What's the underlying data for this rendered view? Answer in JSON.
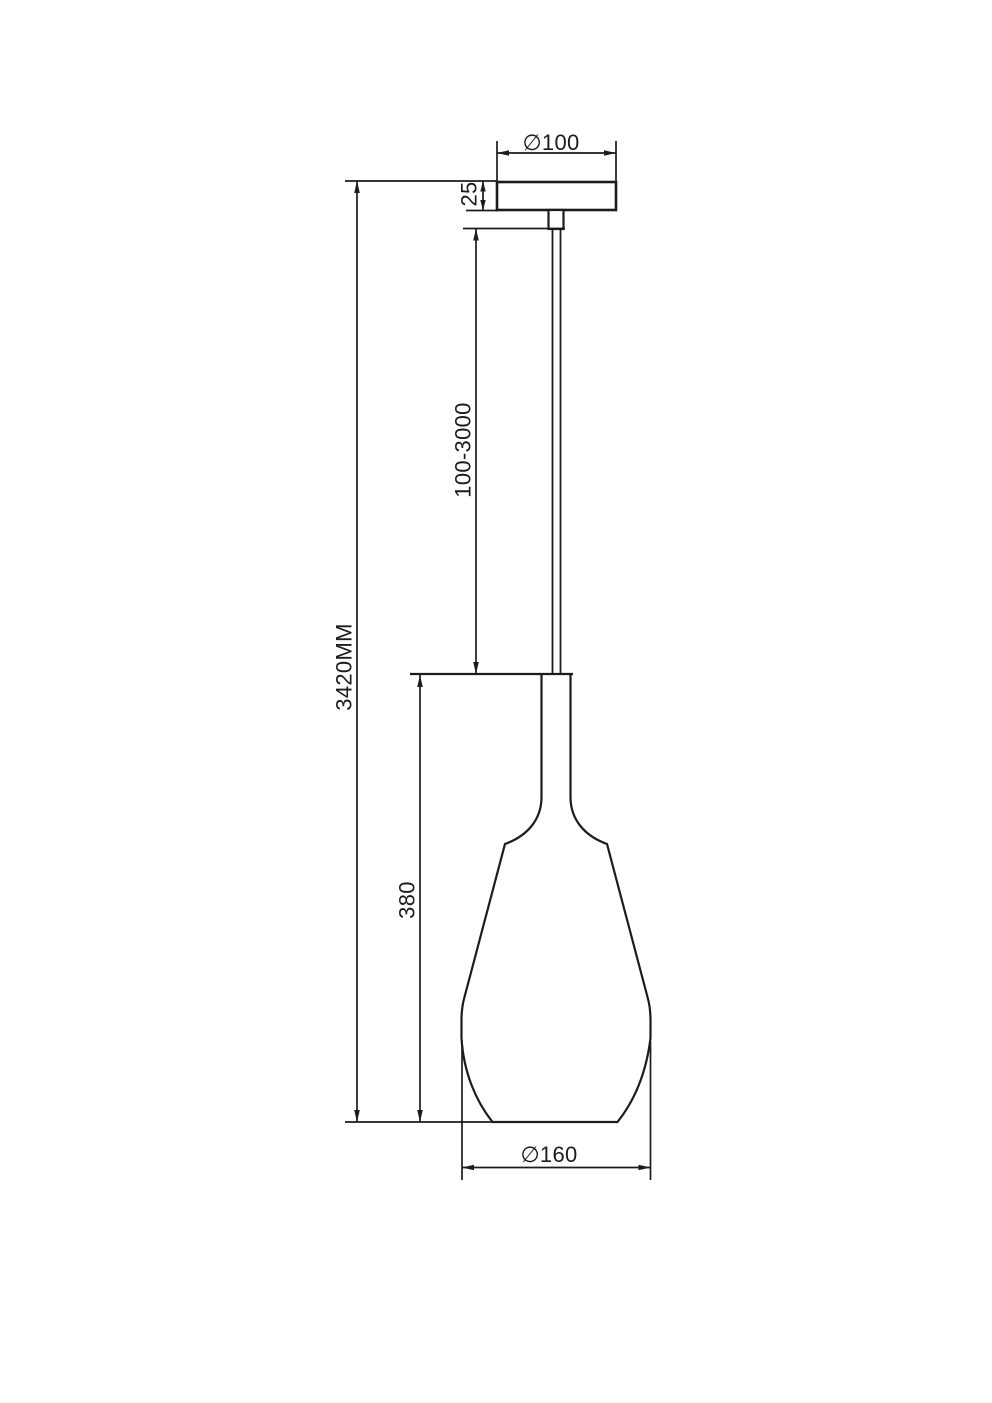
{
  "drawing": {
    "subject": "Pendant lamp technical dimension drawing",
    "background": "#ffffff",
    "line_color": "#1c1c1c",
    "dimensions": {
      "canopy_diameter": "∅100",
      "canopy_height": "25",
      "suspension_length": "100-3000",
      "overall_height": "3420MM",
      "shade_height": "380",
      "shade_diameter": "∅160"
    }
  }
}
